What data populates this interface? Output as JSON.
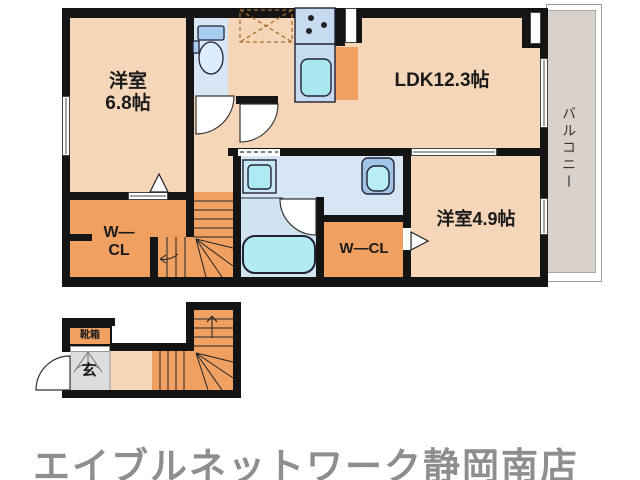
{
  "colors": {
    "wall": "#141414",
    "room_peach": "#f6d6b8",
    "closet_orange": "#f0a162",
    "wet_blue": "#d6e6f4",
    "bath_blue": "#cfe3f1",
    "fixture_cyan": "#aee9f3",
    "counter_blue": "#c6dbef",
    "balcony_gray": "#d9d1cb",
    "entry_gray": "#dcdddf",
    "footer_gray": "#8e8e8e"
  },
  "floorplan": {
    "upper": {
      "bedroom1": {
        "line1": "洋室",
        "line2": "6.8帖"
      },
      "ldk": {
        "name": "LDK12.3帖"
      },
      "bedroom2": {
        "name": "洋室4.9帖"
      },
      "walkin_closet_left": {
        "line1": "W—",
        "line2": "CL"
      },
      "walkin_closet_right": {
        "name": "W—CL"
      },
      "balcony": {
        "name": "バルコニー"
      }
    },
    "lower": {
      "shoe_cabinet": {
        "name": "靴箱"
      },
      "entrance": {
        "name": "玄"
      }
    }
  },
  "footer": {
    "store_name": "エイブルネットワーク静岡南店"
  }
}
